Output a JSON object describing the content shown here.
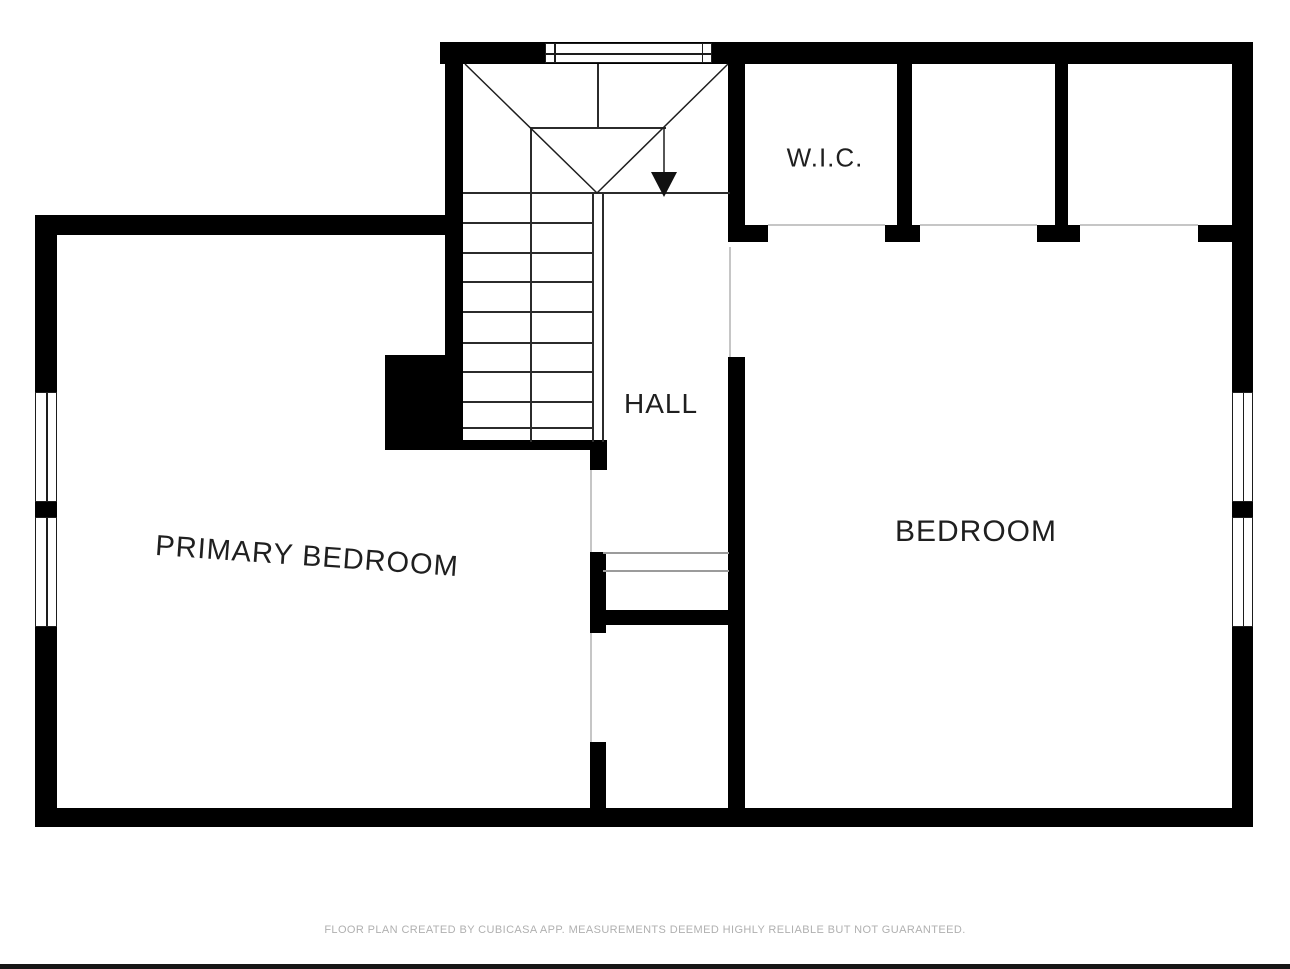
{
  "plan": {
    "room_labels": {
      "primary_bedroom": "PRIMARY BEDROOM",
      "bedroom": "BEDROOM",
      "hall": "HALL",
      "wic": "W.I.C."
    },
    "stairs": {
      "direction": "down"
    },
    "colors": {
      "wall": "#000000",
      "stair_line": "#2b2b2b",
      "opening_line": "#c6c6c6",
      "label_text": "#1f1f1f",
      "disclaimer_text": "#b0b0b0",
      "bottom_bar": "#161616"
    }
  },
  "footer": {
    "disclaimer": "FLOOR PLAN CREATED BY CUBICASA APP. MEASUREMENTS DEEMED HIGHLY RELIABLE BUT NOT GUARANTEED."
  }
}
